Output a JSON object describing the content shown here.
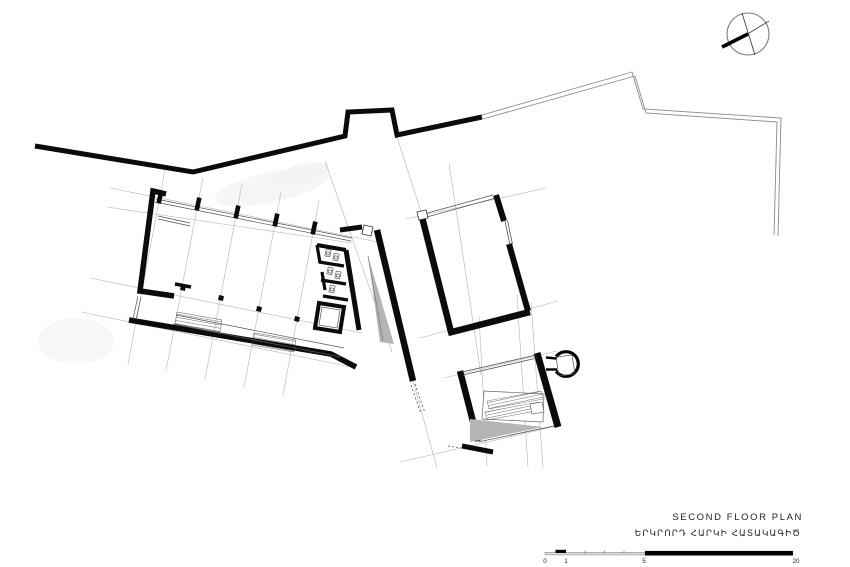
{
  "drawing": {
    "type": "architectural-floor-plan",
    "title": "SECOND FLOOR PLAN",
    "title_localized": "ԵՐԿՐՈՐԴ ՀԱՐԿԻ ՀԱՏԱԿԱԳԻԾ",
    "icons": {
      "north_arrow": "north-arrow-compass"
    },
    "colors": {
      "wall": "#0b0b0b",
      "thin_line": "#555555",
      "grid_line": "#b3b3b3",
      "boundary": "#8a8a8a",
      "ramp_fill": "#b5b5b5",
      "paper": "#ffffff"
    },
    "scale_bar": {
      "labels": [
        "0",
        "1",
        "5",
        "20"
      ]
    }
  }
}
